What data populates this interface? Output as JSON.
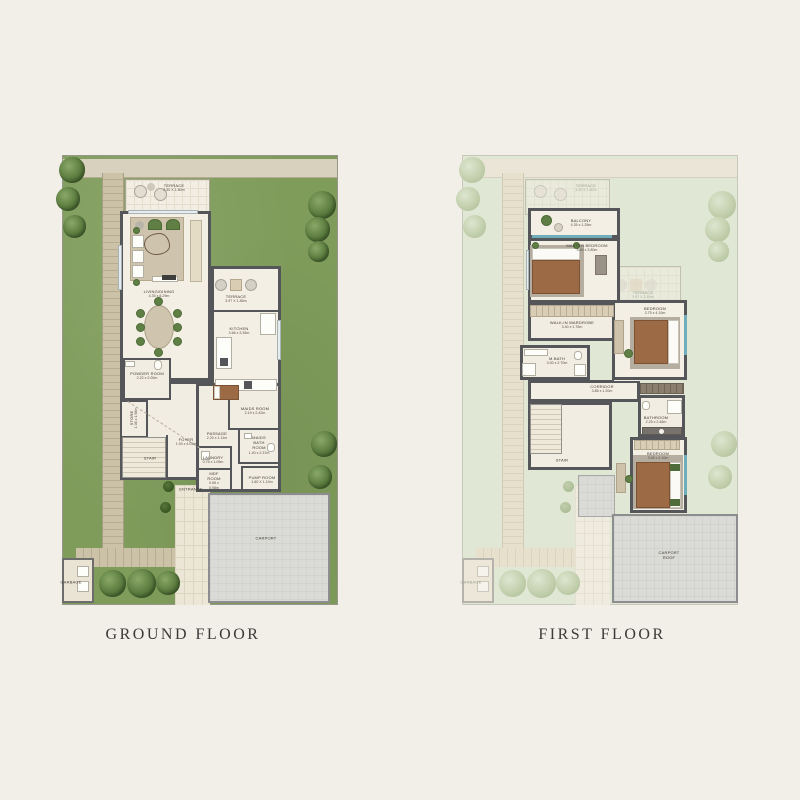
{
  "captions": {
    "ground": "GROUND FLOOR",
    "first": "FIRST FLOOR"
  },
  "colors": {
    "paper": "#f2efe9",
    "garden_green": "#7f9c5b",
    "garden_pale": "#e1e7d5",
    "wall_dark": "#55565a",
    "carport_gray": "#dadad6",
    "path_tan": "#ccc2a8",
    "accent_teal": "#6fadbb"
  },
  "ground": {
    "rooms": {
      "terrace_top": {
        "name": "TERRACE",
        "dims": "4.30 X 1.80m"
      },
      "living": {
        "name": "LIVING/DINING",
        "dims": "4.35 x 8.29m"
      },
      "terrace_side": {
        "name": "TERRACE",
        "dims": "3.97 X 1.85m"
      },
      "kitchen": {
        "name": "KITCHEN",
        "dims": "3.66 x 3.35m"
      },
      "powder": {
        "name": "POWDER ROOM",
        "dims": "2.22 x 2.00m"
      },
      "store": {
        "name": "STORE",
        "dims": "1.08 x 1.98m"
      },
      "foyer": {
        "name": "FOYER",
        "dims": "1.93 x 4.03m"
      },
      "stair": {
        "name": "STAIR",
        "dims": ""
      },
      "passage": {
        "name": "PASSAGE",
        "dims": "2.20 x 1.11m"
      },
      "laundry": {
        "name": "LAUNDRY",
        "dims": "0.75 x 1.05m"
      },
      "maids_room": {
        "name": "MAIDS ROOM",
        "dims": "2.19 x 2.42m"
      },
      "maids_bath": {
        "name": "MAIDS BATH ROOM",
        "dims": "1.40 x 2.37m"
      },
      "mdf_room": {
        "name": "MDF ROOM",
        "dims": "0.65 x 0.98m"
      },
      "pump_room": {
        "name": "PUMP ROOM",
        "dims": "1.60 X 1.10m"
      },
      "entrance": {
        "name": "ENTRANCE",
        "dims": ""
      },
      "carport": {
        "name": "CARPORT",
        "dims": ""
      },
      "garbage": {
        "name": "GARBAGE",
        "dims": ""
      }
    }
  },
  "first": {
    "rooms": {
      "terrace_top": {
        "name": "TERRACE",
        "dims": "4.30 X 1.80m"
      },
      "terrace_side": {
        "name": "TERRACE",
        "dims": "3.97 X 1.85m"
      },
      "balcony": {
        "name": "BALCONY",
        "dims": "4.35 x 1.25m"
      },
      "master": {
        "name": "MASTER BEDROOM",
        "dims": "4.60 x 3.80m"
      },
      "wardrobe": {
        "name": "WALK-IN WARDROBE",
        "dims": "3.40 x 1.75m"
      },
      "mbath": {
        "name": "M.BATH",
        "dims": "3.00 x 2.70m"
      },
      "corridor": {
        "name": "CORRIDOR",
        "dims": "3.86 x 1.20m"
      },
      "bedroom1": {
        "name": "BEDROOM",
        "dims": "3.75 x 4.10m"
      },
      "bathroom": {
        "name": "BATHROOM",
        "dims": "2.25 x 2.46m"
      },
      "bedroom2": {
        "name": "BEDROOM",
        "dims": "3.65 x 4.10m"
      },
      "stair": {
        "name": "STAIR",
        "dims": ""
      },
      "carport_roof": {
        "name": "CARPORT ROOF",
        "dims": ""
      },
      "garbage": {
        "name": "GARBAGE",
        "dims": ""
      }
    }
  }
}
